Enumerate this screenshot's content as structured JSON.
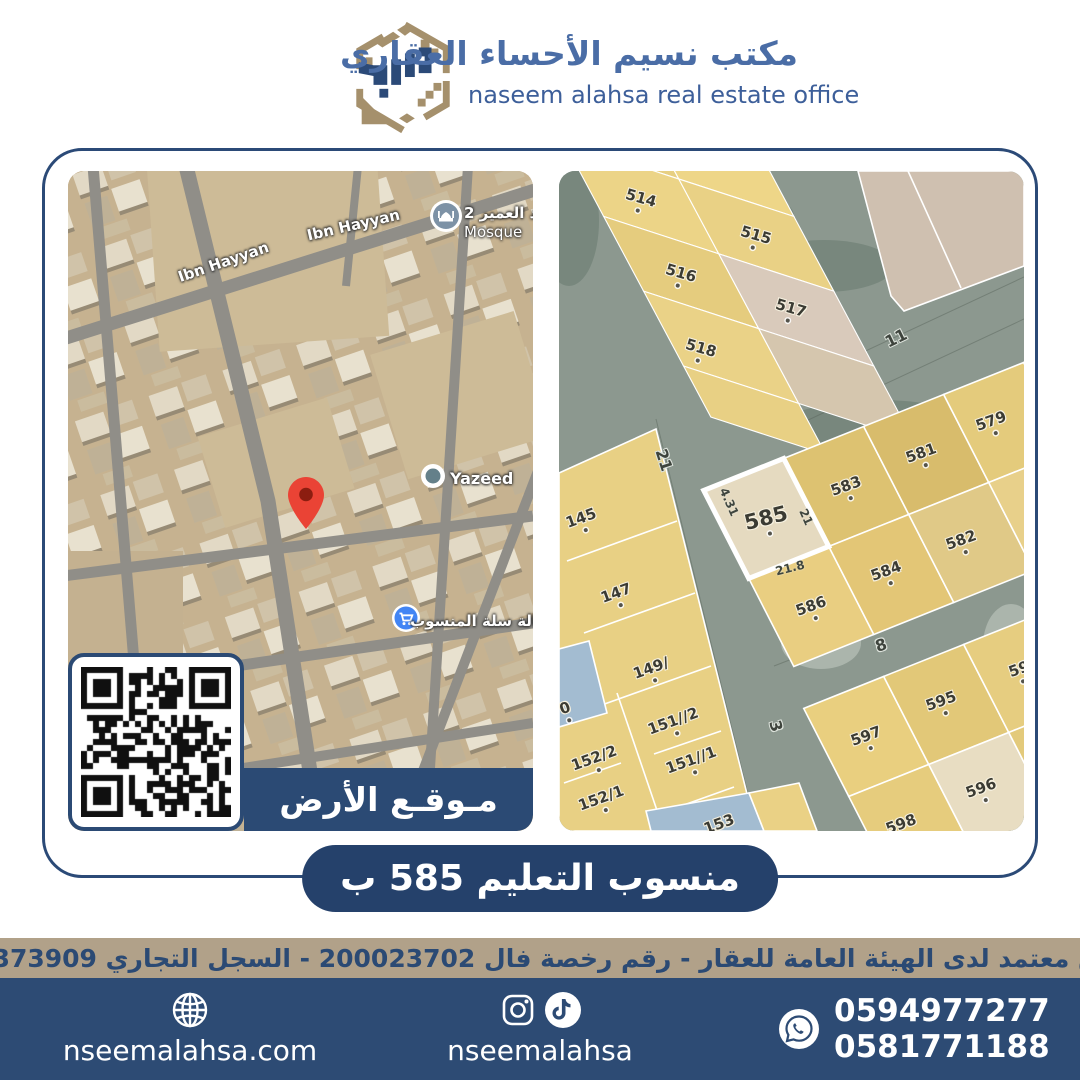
{
  "header": {
    "logo": "naseem-alahsa-logo",
    "title_ar": "مكتب نسيم الأحساء العقاري",
    "title_en": "naseem alahsa real estate office"
  },
  "satellite_map": {
    "streets": [
      {
        "label": "Ibn Hayyan"
      },
      {
        "label": "Ibn Hayyan"
      }
    ],
    "mosque": {
      "icon": "mosque-icon",
      "name_ar": "مسجد العمير 2",
      "name_en": "Mosque"
    },
    "yazeed": {
      "icon": "poi-dot-icon",
      "name": "Yazeed"
    },
    "grocery": {
      "icon": "shopping-cart-icon",
      "name": "بقالة سلة المنسوب"
    },
    "pin": "location-pin-icon",
    "qr": "qr-code",
    "location_tag": "مـوقـع الأرض"
  },
  "parcel_map": {
    "subject": {
      "label": "585",
      "dim_left": "4.31",
      "dim_right": "21",
      "dim_bottom": "21.8"
    },
    "parcels": [
      {
        "label": "514"
      },
      {
        "label": "515"
      },
      {
        "label": "516"
      },
      {
        "label": "517"
      },
      {
        "label": "518"
      },
      {
        "label": "579"
      },
      {
        "label": "581"
      },
      {
        "label": "583"
      },
      {
        "label": "582"
      },
      {
        "label": "584"
      },
      {
        "label": "586"
      },
      {
        "label": "145"
      },
      {
        "label": "147"
      },
      {
        "label": "149/"
      },
      {
        "label": "151//2"
      },
      {
        "label": "151//1"
      },
      {
        "label": "152/2"
      },
      {
        "label": "152/1"
      },
      {
        "label": "153"
      },
      {
        "label": "595"
      },
      {
        "label": "597"
      },
      {
        "label": "596"
      },
      {
        "label": "598"
      },
      {
        "label": "59"
      },
      {
        "label": "0"
      }
    ],
    "streets": [
      {
        "label": "11"
      },
      {
        "label": "21"
      },
      {
        "label": "8"
      },
      {
        "label": "3"
      }
    ]
  },
  "banner": {
    "text": "منسوب التعليم 585 ب"
  },
  "license_bar": {
    "text": "مسوق معتمد لدى الهيئة العامة للعقار - رقم رخصة فال 200023702 - السجل التجاري 2250373909"
  },
  "footer": {
    "website": {
      "icon": "globe-icon",
      "label": "nseemalahsa.com"
    },
    "social": {
      "icons": [
        "instagram-icon",
        "tiktok-icon"
      ],
      "handle": "nseemalahsa"
    },
    "contact": {
      "icon": "whatsapp-icon",
      "phone1": "0594977277",
      "phone2": "0581771188"
    }
  },
  "colors": {
    "navy": "#2d4b74",
    "navy_deep": "#25416b",
    "card_border": "#2b4a77",
    "tan_bar": "#b1a189",
    "logo_tan": "#a5906c",
    "parcel_yellow": "#e9d185",
    "subject_parcel": "#e5dac0",
    "pin_red": "#ea4335",
    "poi_blue": "#4285f4"
  }
}
